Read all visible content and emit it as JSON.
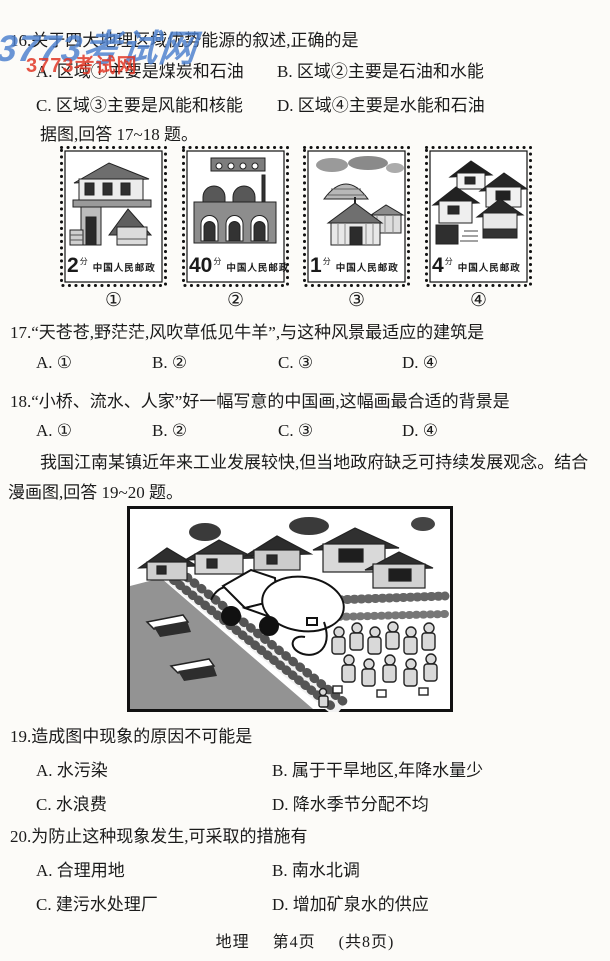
{
  "watermark": {
    "blue_text": "3773考试网",
    "red_text": "3773考试网",
    "blue_color": "#4b7fce",
    "red_color": "#e23726"
  },
  "q16": {
    "stem": "16.关于四大地理区域优势能源的叙述,正确的是",
    "options": [
      "A. 区域①主要是煤炭和石油",
      "B. 区域②主要是石油和水能",
      "C. 区域③主要是风能和核能",
      "D. 区域④主要是水能和石油"
    ],
    "instruction": "据图,回答 17~18 题。"
  },
  "stamps": {
    "items": [
      {
        "value": "2",
        "unit": "分",
        "inscription": "中国人民邮政",
        "caption": "①",
        "depicts": "north-china-brick-house"
      },
      {
        "value": "40",
        "unit": "分",
        "inscription": "中国人民邮政",
        "caption": "②",
        "depicts": "loess-cave-dwelling"
      },
      {
        "value": "1",
        "unit": "分",
        "inscription": "中国人民邮政",
        "caption": "③",
        "depicts": "mongolian-yurts"
      },
      {
        "value": "4",
        "unit": "分",
        "inscription": "中国人民邮政",
        "caption": "④",
        "depicts": "jiangnan-water-town-houses"
      }
    ]
  },
  "q17": {
    "stem": "17.“天苍苍,野茫茫,风吹草低见牛羊”,与这种风景最适应的建筑是",
    "options": [
      "A. ①",
      "B. ②",
      "C. ③",
      "D. ④"
    ]
  },
  "q18": {
    "stem": "18.“小桥、流水、人家”好一幅写意的中国画,这幅画最合适的背景是",
    "options": [
      "A. ①",
      "B. ②",
      "C. ③",
      "D. ④"
    ]
  },
  "passage": "我国江南某镇近年来工业发展较快,但当地政府缺乏可持续发展观念。结合漫画图,回答 19~20 题。",
  "cartoon": {
    "name": "water-pollution-village-cartoon"
  },
  "q19": {
    "stem": "19.造成图中现象的原因不可能是",
    "options": [
      "A. 水污染",
      "B. 属于干旱地区,年降水量少",
      "C. 水浪费",
      "D. 降水季节分配不均"
    ]
  },
  "q20": {
    "stem": "20.为防止这种现象发生,可采取的措施有",
    "options": [
      "A. 合理用地",
      "B. 南水北调",
      "C. 建污水处理厂",
      "D. 增加矿泉水的供应"
    ]
  },
  "footer": {
    "subject": "地理",
    "page": "第4页",
    "total": "(共8页)"
  }
}
